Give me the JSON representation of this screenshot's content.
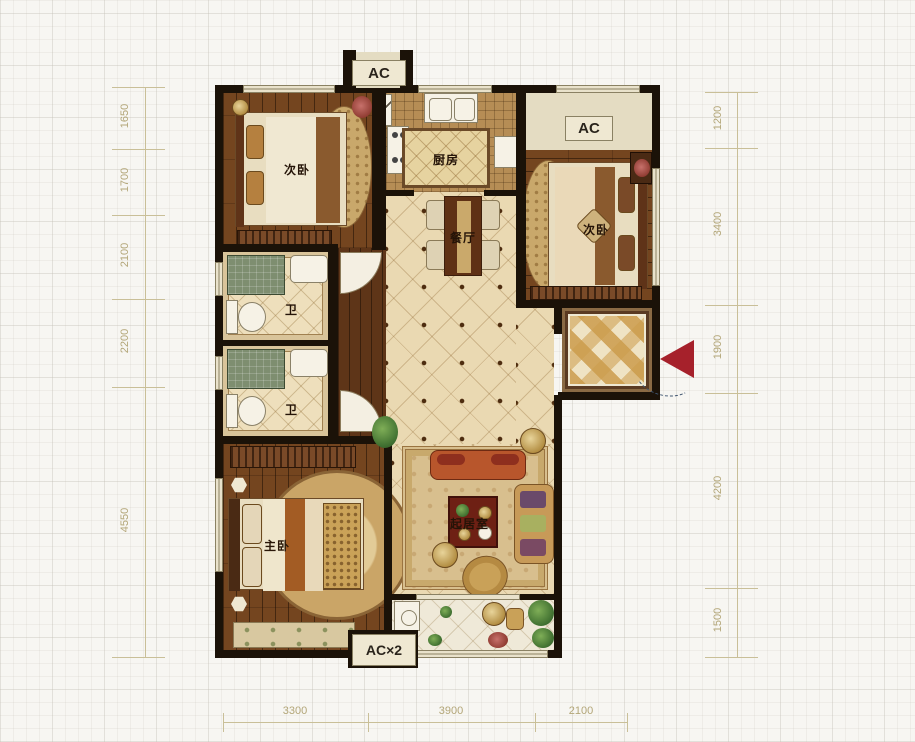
{
  "title": "apartment-floor-plan",
  "rooms": {
    "bedroom_top_left": "次卧",
    "bedroom_right": "次卧",
    "kitchen": "厨房",
    "dining": "餐厅",
    "living": "起居室",
    "master_bedroom": "主卧",
    "bath_upper": "卫",
    "bath_lower": "卫"
  },
  "ac_units": {
    "top": "AC",
    "right": "AC",
    "bottom": "AC×2"
  },
  "dimensions": {
    "left": [
      "1650",
      "1700",
      "2100",
      "2200",
      "4550"
    ],
    "right": [
      "1200",
      "3400",
      "1900",
      "4200",
      "1500"
    ],
    "bottom": [
      "3300",
      "3900",
      "2100"
    ]
  },
  "colors": {
    "entry_arrow": "#a6212b",
    "dimension_text": "#b3a678",
    "wall": "#1b1208",
    "wood_floor": "#74451f",
    "tile_floor": "#ead9b2",
    "window_fill": "#e9e2cb",
    "shower_tile": "#7e8e70",
    "checker_dark": "#d8b26a",
    "checker_light": "#efe3c4"
  }
}
